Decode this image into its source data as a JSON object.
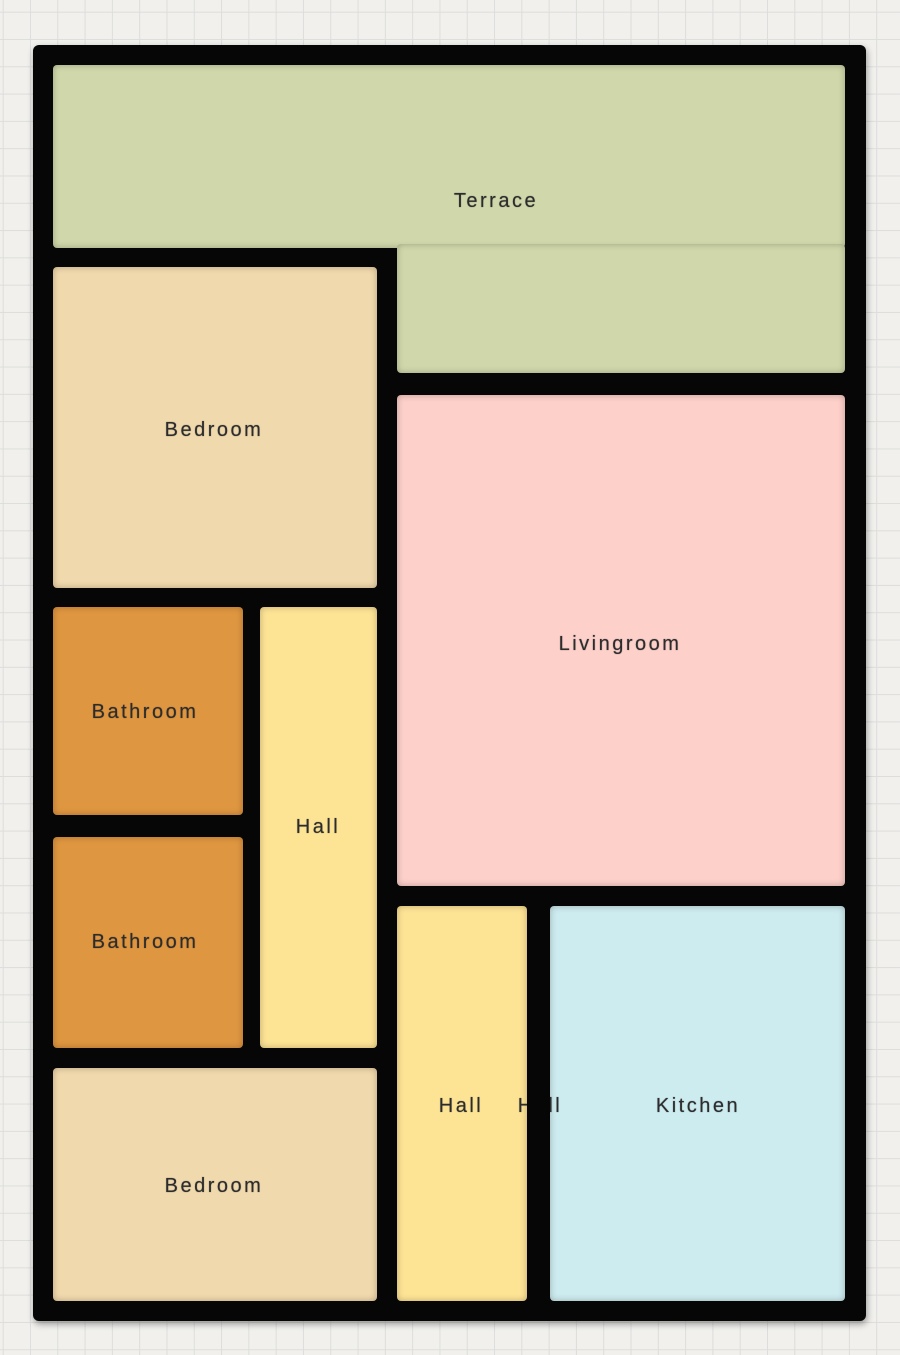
{
  "floorplan": {
    "wall_color": "#060606",
    "canvas": {
      "background_color": "#f1f0ed",
      "grid_line_color": "#dddddb",
      "grid_size_px": 27.3
    },
    "building": {
      "x": 33,
      "y": 45,
      "width": 833,
      "height": 1276
    },
    "rooms": [
      {
        "id": "terrace",
        "label": "Terrace",
        "color": "#d0d8ab",
        "rects": [
          {
            "x": 53,
            "y": 65,
            "w": 792,
            "h": 183
          },
          {
            "x": 397,
            "y": 244,
            "w": 448,
            "h": 129
          }
        ],
        "label_x": 496,
        "label_y": 201,
        "under_wall": false
      },
      {
        "id": "bedroom-top",
        "label": "Bedroom",
        "color": "#f0d9ad",
        "rects": [
          {
            "x": 53,
            "y": 267,
            "w": 324,
            "h": 321
          }
        ],
        "label_x": 214,
        "label_y": 430,
        "under_wall": false
      },
      {
        "id": "livingroom",
        "label": "Livingroom",
        "color": "#fdd0ca",
        "rects": [
          {
            "x": 397,
            "y": 395,
            "w": 448,
            "h": 491
          }
        ],
        "label_x": 620,
        "label_y": 644,
        "under_wall": false
      },
      {
        "id": "bathroom-upper",
        "label": "Bathroom",
        "color": "#df9640",
        "rects": [
          {
            "x": 53,
            "y": 607,
            "w": 190,
            "h": 208
          }
        ],
        "label_x": 145,
        "label_y": 712,
        "under_wall": false
      },
      {
        "id": "bathroom-lower",
        "label": "Bathroom",
        "color": "#df9640",
        "rects": [
          {
            "x": 53,
            "y": 837,
            "w": 190,
            "h": 211
          }
        ],
        "label_x": 145,
        "label_y": 942,
        "under_wall": false
      },
      {
        "id": "hall-west",
        "label": "Hall",
        "color": "#fde495",
        "rects": [
          {
            "x": 260,
            "y": 607,
            "w": 117,
            "h": 441
          }
        ],
        "label_x": 318,
        "label_y": 827,
        "under_wall": false
      },
      {
        "id": "bedroom-bottom",
        "label": "Bedroom",
        "color": "#f0d9ad",
        "rects": [
          {
            "x": 53,
            "y": 1068,
            "w": 324,
            "h": 233
          }
        ],
        "label_x": 214,
        "label_y": 1186,
        "under_wall": false
      },
      {
        "id": "hall-south",
        "label": "Hall",
        "color": "#fde495",
        "rects": [
          {
            "x": 397,
            "y": 906,
            "w": 130,
            "h": 395
          }
        ],
        "label_x": 461,
        "label_y": 1106,
        "under_wall": false
      },
      {
        "id": "hall-hidden",
        "label": "Hall",
        "color": "#fde495",
        "rects": [],
        "label_x": 540,
        "label_y": 1106,
        "under_wall": true
      },
      {
        "id": "kitchen",
        "label": "Kitchen",
        "color": "#cdecf0",
        "rects": [
          {
            "x": 550,
            "y": 906,
            "w": 295,
            "h": 395
          }
        ],
        "label_x": 698,
        "label_y": 1106,
        "under_wall": false
      }
    ],
    "wall_overlays": [
      {
        "x": 527,
        "y": 906,
        "w": 23,
        "h": 395
      }
    ]
  }
}
